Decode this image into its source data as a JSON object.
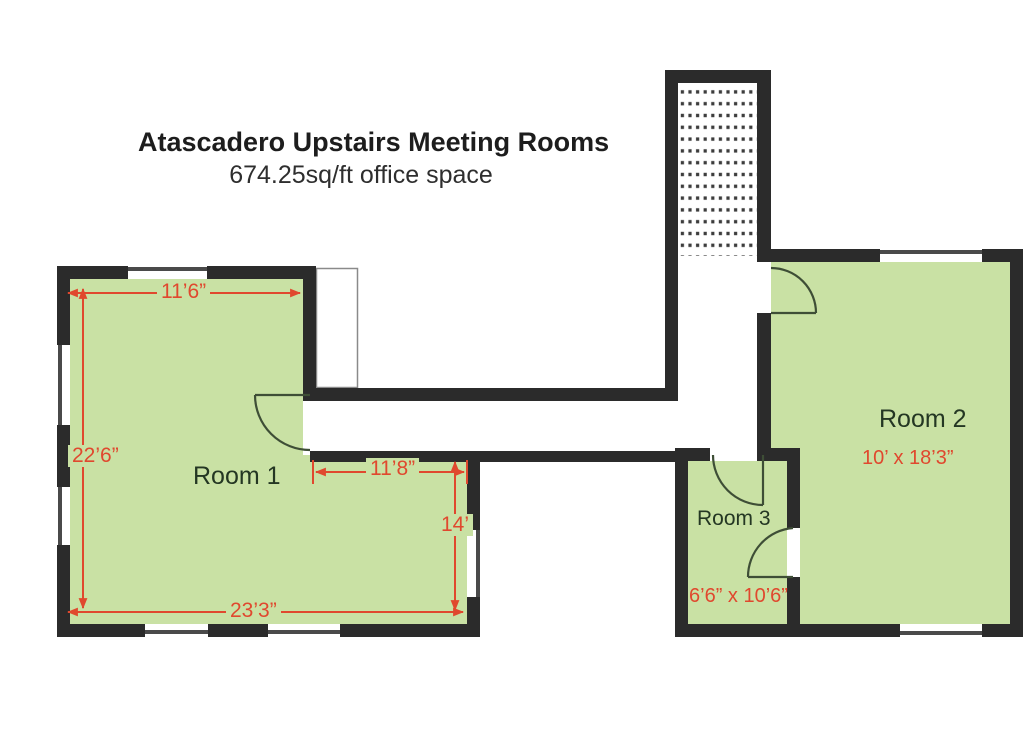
{
  "header": {
    "title": "Atascadero Upstairs Meeting Rooms",
    "subtitle": "674.25sq/ft office space"
  },
  "room1": {
    "name": "Room 1",
    "width_top": "11’6”",
    "height_left": "22’6”",
    "inner_width": "11’8”",
    "inner_height": "14’",
    "width_bottom": "23’3”"
  },
  "room2": {
    "name": "Room 2",
    "size": "10’ x 18’3”"
  },
  "room3": {
    "name": "Room 3",
    "size": "6’6” x 10’6”"
  },
  "colors": {
    "room_fill": "#c9e1a4",
    "wall": "#2b2b2b",
    "window_line": "#4a4a4a",
    "dimension": "#e0482e",
    "room_label": "#243723"
  }
}
